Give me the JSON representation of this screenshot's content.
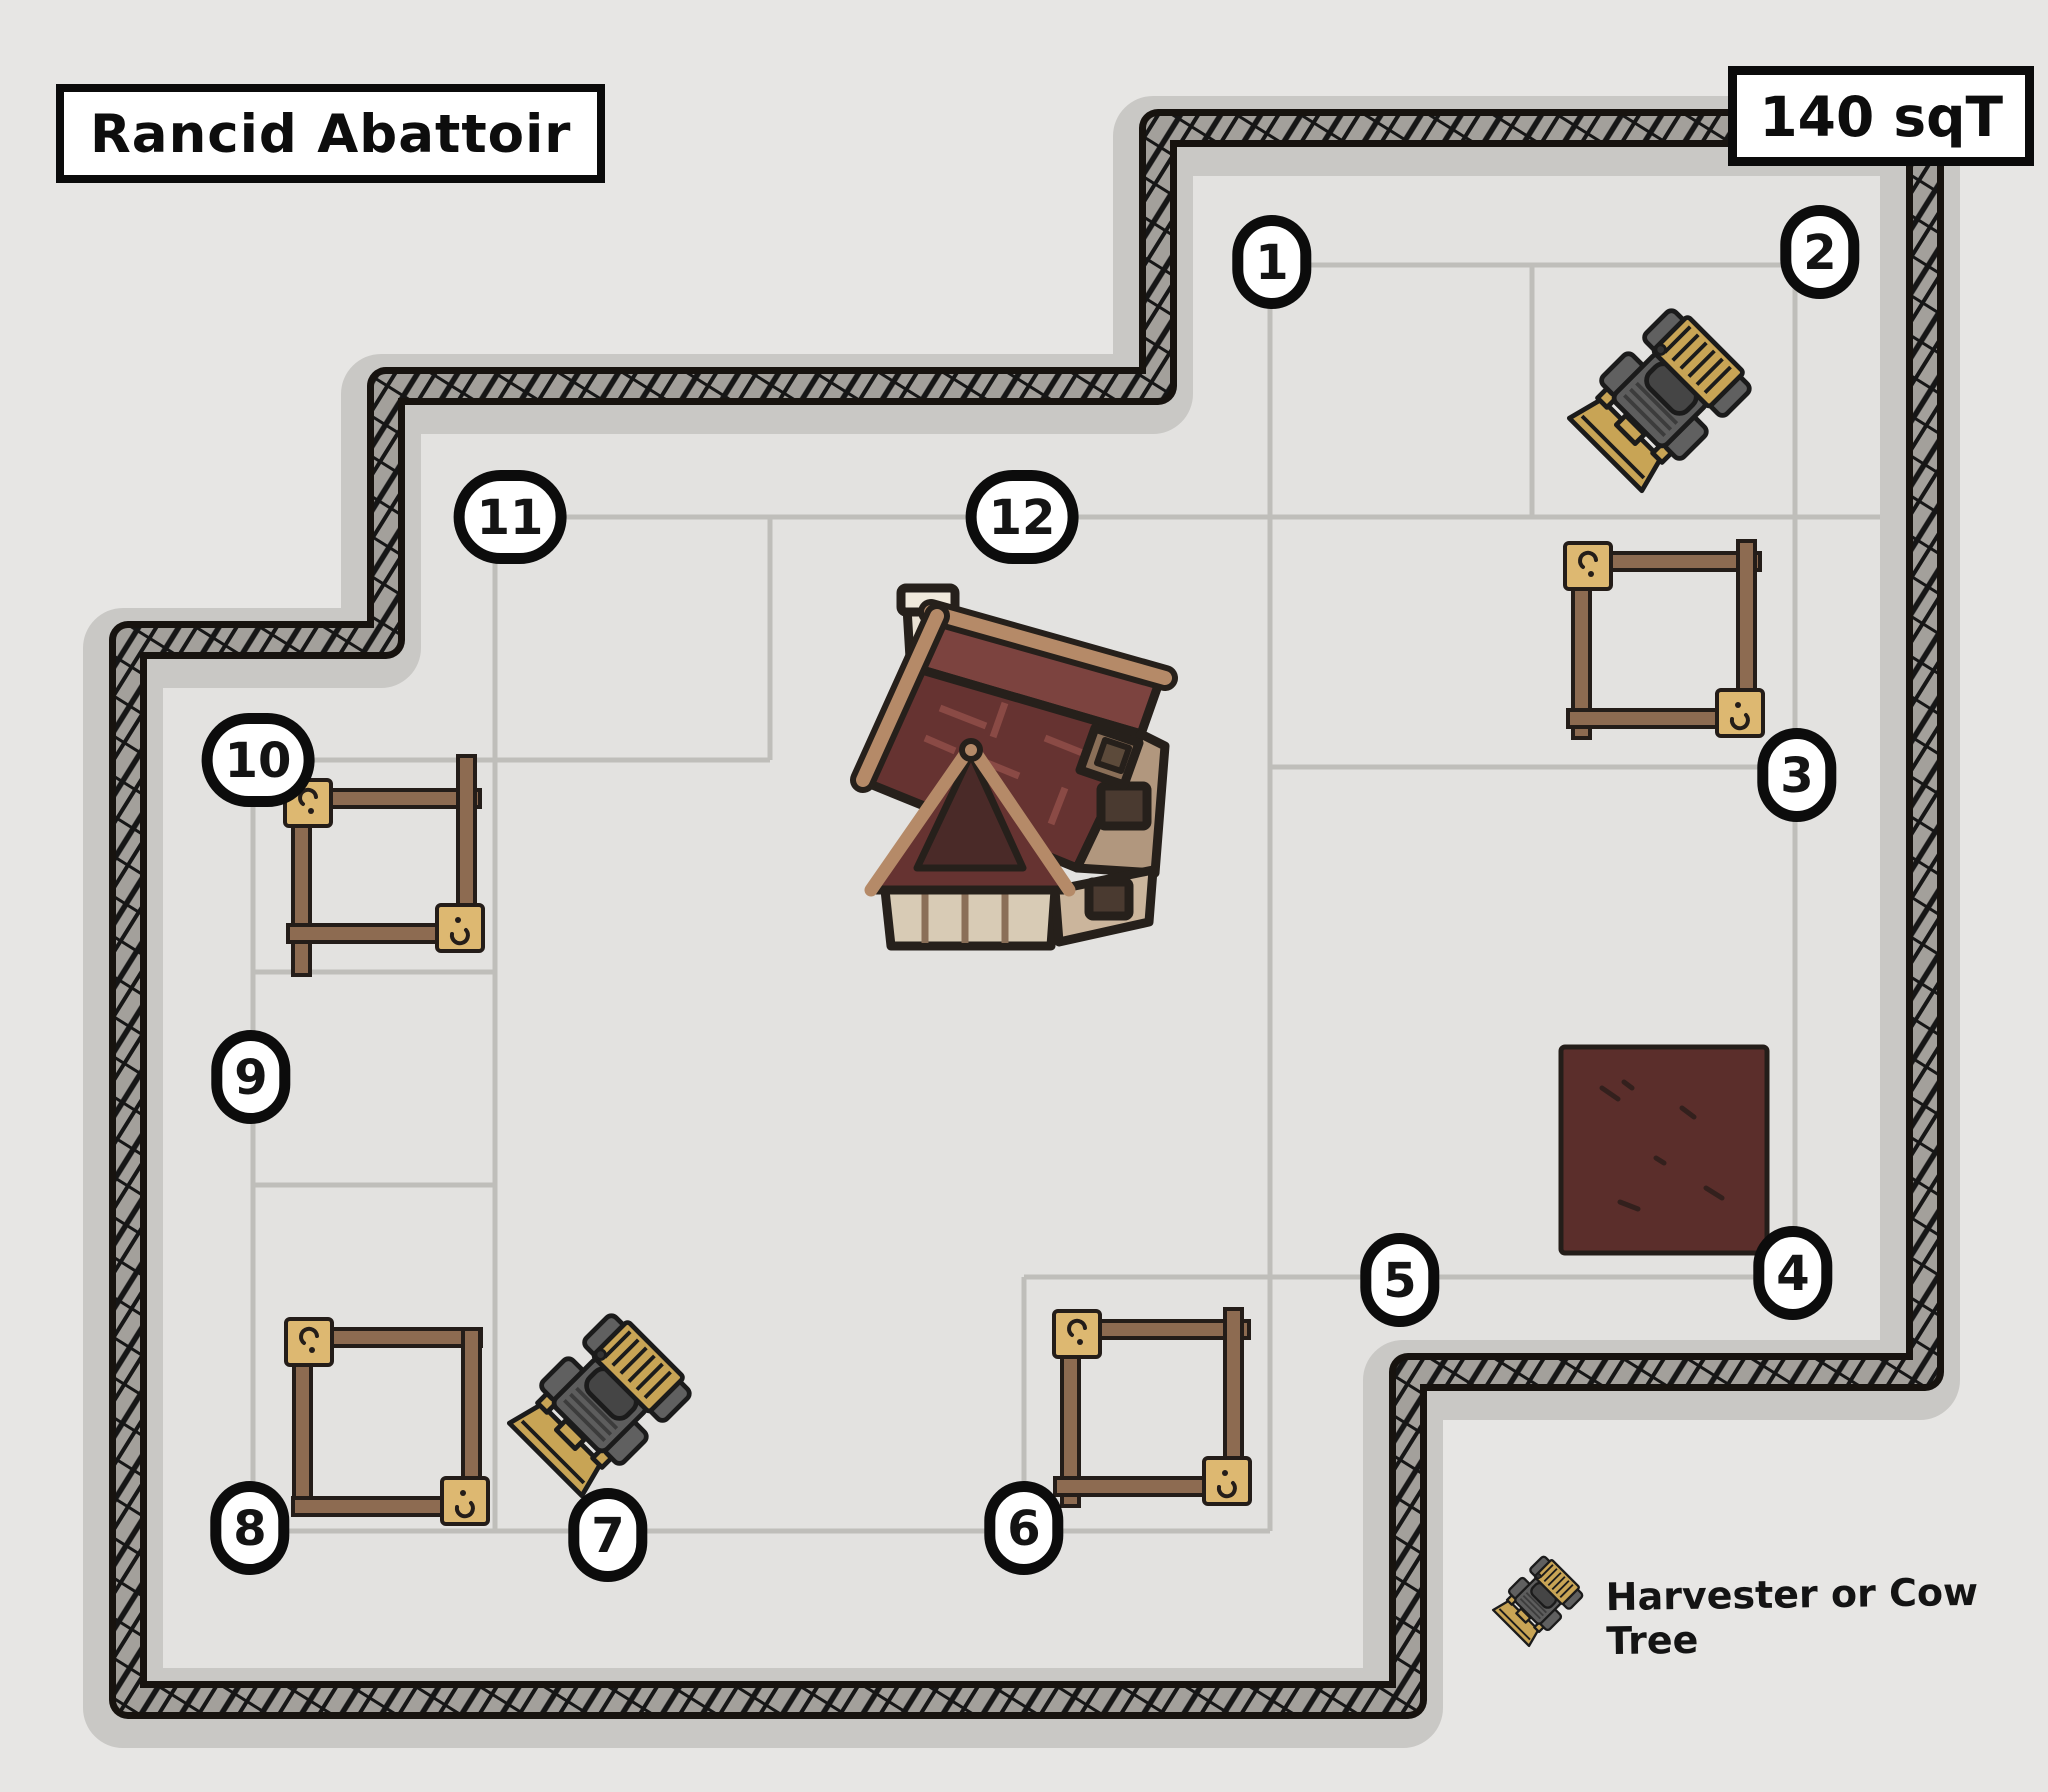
{
  "header": {
    "title": "Rancid Abattoir",
    "area_label": "140 sqT"
  },
  "legend": {
    "label": "Harvester or Cow Tree",
    "icon": "harvester-icon"
  },
  "colors": {
    "page-bg": "#e7e6e4",
    "interior": "#e3e2e0",
    "shadow-gray": "#c9c8c5",
    "ink": "#17130f",
    "band-gray": "#a3a09b",
    "fence-gray": "#bfbeba",
    "badge-ink": "#0c0c0c",
    "patch-red": "#5b2e2b",
    "harvester-tan": "#c8a455",
    "machine-gray": "#5d5d5d",
    "wood-brown": "#8d6b51",
    "block-tan": "#ddb871",
    "roof-red": "#663331",
    "roof-red-light": "#7c433f",
    "beam-tan": "#b58a68",
    "wall-cream": "#d8cbb5"
  },
  "map": {
    "outline": [
      [
        1158,
        128
      ],
      [
        1925,
        128
      ],
      [
        1925,
        1372
      ],
      [
        1408,
        1372
      ],
      [
        1408,
        1700
      ],
      [
        128,
        1700
      ],
      [
        128,
        640
      ],
      [
        386,
        640
      ],
      [
        386,
        386
      ],
      [
        1158,
        386
      ]
    ],
    "fences": [
      [
        1270,
        265,
        1795,
        265
      ],
      [
        495,
        517,
        1905,
        517
      ],
      [
        258,
        760,
        770,
        760
      ],
      [
        1270,
        767,
        1795,
        767
      ],
      [
        253,
        972,
        495,
        972
      ],
      [
        253,
        1185,
        495,
        1185
      ],
      [
        1024,
        1277,
        1795,
        1277
      ],
      [
        253,
        1531,
        1270,
        1531
      ],
      [
        253,
        760,
        253,
        1531
      ],
      [
        495,
        517,
        495,
        1531
      ],
      [
        770,
        517,
        770,
        760
      ],
      [
        1270,
        265,
        1270,
        1531
      ],
      [
        1532,
        265,
        1532,
        517
      ],
      [
        1795,
        265,
        1795,
        1277
      ],
      [
        1024,
        1277,
        1024,
        1531
      ]
    ],
    "badges": [
      {
        "label": "1",
        "x": 1272,
        "y": 262
      },
      {
        "label": "2",
        "x": 1820,
        "y": 252
      },
      {
        "label": "3",
        "x": 1797,
        "y": 775
      },
      {
        "label": "4",
        "x": 1793,
        "y": 1273
      },
      {
        "label": "5",
        "x": 1400,
        "y": 1280
      },
      {
        "label": "6",
        "x": 1024,
        "y": 1528
      },
      {
        "label": "7",
        "x": 608,
        "y": 1535
      },
      {
        "label": "8",
        "x": 250,
        "y": 1528
      },
      {
        "label": "9",
        "x": 251,
        "y": 1077
      },
      {
        "label": "10",
        "x": 258,
        "y": 760
      },
      {
        "label": "11",
        "x": 510,
        "y": 517
      },
      {
        "label": "12",
        "x": 1022,
        "y": 517
      }
    ],
    "objects": [
      {
        "type": "patch",
        "x": 1664,
        "y": 1150,
        "r": 0,
        "s": 1,
        "name": "soil-patch"
      },
      {
        "type": "house",
        "x": 1020,
        "y": 764,
        "r": 0,
        "s": 1,
        "name": "farmhouse"
      },
      {
        "type": "harvester",
        "x": 1660,
        "y": 400,
        "r": 225,
        "s": 0.95,
        "name": "harvester-paddock-2"
      },
      {
        "type": "harvester",
        "x": 600,
        "y": 1405,
        "r": 225,
        "s": 0.95,
        "name": "harvester-paddock-7"
      },
      {
        "type": "harvester",
        "x": 1538,
        "y": 1601,
        "r": 225,
        "s": 0.47,
        "name": "legend-harvester-icon"
      },
      {
        "type": "spr-tl",
        "x": 308,
        "y": 803,
        "r": 0,
        "s": 1,
        "name": "corner-marker-tl-paddock-10"
      },
      {
        "type": "spr-br",
        "x": 460,
        "y": 928,
        "r": 0,
        "s": 1,
        "name": "corner-marker-br-paddock-10"
      },
      {
        "type": "spr-tl",
        "x": 309,
        "y": 1342,
        "r": 0,
        "s": 1,
        "name": "corner-marker-tl-paddock-8"
      },
      {
        "type": "spr-br",
        "x": 465,
        "y": 1501,
        "r": 0,
        "s": 1,
        "name": "corner-marker-br-paddock-8"
      },
      {
        "type": "spr-tl",
        "x": 1588,
        "y": 566,
        "r": 0,
        "s": 1,
        "name": "corner-marker-tl-paddock-3"
      },
      {
        "type": "spr-br",
        "x": 1740,
        "y": 713,
        "r": 0,
        "s": 1,
        "name": "corner-marker-br-paddock-3"
      },
      {
        "type": "spr-tl",
        "x": 1077,
        "y": 1334,
        "r": 0,
        "s": 1,
        "name": "corner-marker-tl-paddock-6"
      },
      {
        "type": "spr-br",
        "x": 1227,
        "y": 1481,
        "r": 0,
        "s": 1,
        "name": "corner-marker-br-paddock-6"
      }
    ]
  }
}
